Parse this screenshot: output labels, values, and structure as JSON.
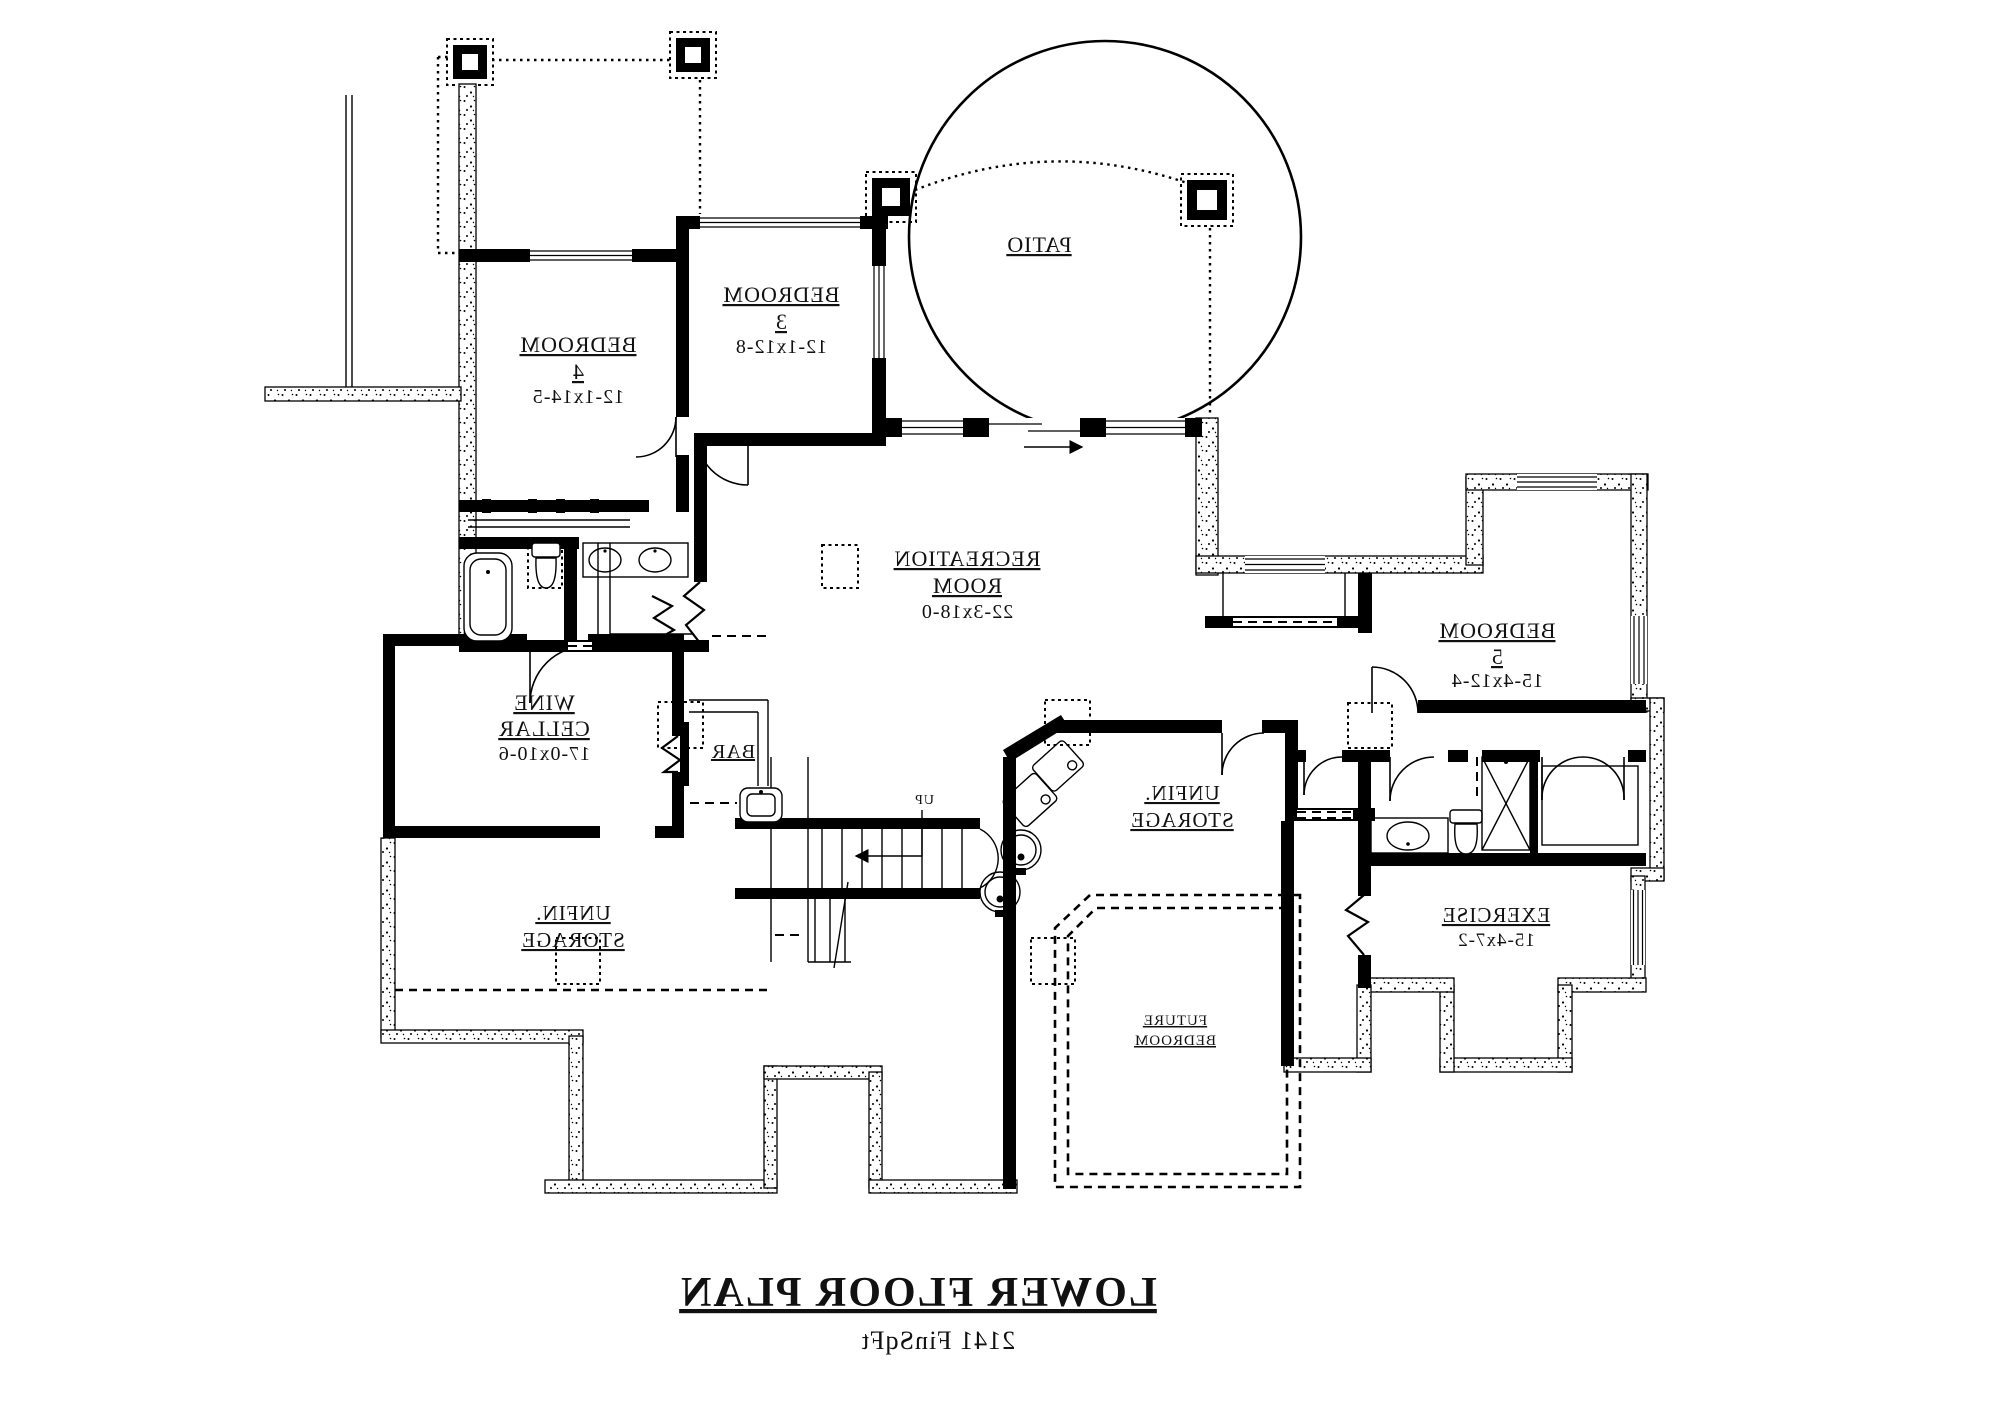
{
  "document": {
    "type": "floor-plan-drawing",
    "orientation": "mirrored",
    "background_color": "#ffffff",
    "line_color": "#000000"
  },
  "title_block": {
    "heading": "LOWER FLOOR PLAN",
    "area": "2141 FinSqFt"
  },
  "rooms": [
    {
      "name": "PATIO",
      "dims": ""
    },
    {
      "name": "BEDROOM 3",
      "dims": "12-1x12-8"
    },
    {
      "name": "BEDROOM 4",
      "dims": "12-1x14-5"
    },
    {
      "name": "RECREATION ROOM",
      "dims": "22-3x18-0"
    },
    {
      "name": "WINE CELLAR",
      "dims": "17-0x10-6"
    },
    {
      "name": "BAR",
      "dims": ""
    },
    {
      "name": "UNFIN. STORAGE (left)",
      "dims": ""
    },
    {
      "name": "UNFIN. STORAGE (center)",
      "dims": ""
    },
    {
      "name": "FUTURE BEDROOM",
      "dims": ""
    },
    {
      "name": "BEDROOM 5",
      "dims": "15-4x12-4"
    },
    {
      "name": "EXERCISE",
      "dims": "15-4x7-2"
    },
    {
      "name": "UP (stairs)",
      "dims": ""
    }
  ],
  "labels": [
    {
      "name": "patio-label",
      "x": 1039,
      "y": 252,
      "lines": [
        {
          "t": "PATIO",
          "dy": 0,
          "s": 22,
          "u": true
        }
      ]
    },
    {
      "name": "bedroom-3-label",
      "x": 781,
      "y": 302,
      "lines": [
        {
          "t": "BEDROOM",
          "dy": 0,
          "s": 22,
          "u": true
        },
        {
          "t": "3",
          "dy": 27,
          "s": 22,
          "u": true
        },
        {
          "t": "12-1x12-8",
          "dy": 51,
          "s": 20,
          "u": false
        }
      ]
    },
    {
      "name": "bedroom-4-label",
      "x": 578,
      "y": 352,
      "lines": [
        {
          "t": "BEDROOM",
          "dy": 0,
          "s": 22,
          "u": true
        },
        {
          "t": "4",
          "dy": 27,
          "s": 22,
          "u": true
        },
        {
          "t": "12-1x14-5",
          "dy": 51,
          "s": 20,
          "u": false
        }
      ]
    },
    {
      "name": "recreation-room-label",
      "x": 967,
      "y": 566,
      "lines": [
        {
          "t": "RECREATION",
          "dy": 0,
          "s": 22,
          "u": true
        },
        {
          "t": "ROOM",
          "dy": 27,
          "s": 22,
          "u": true
        },
        {
          "t": "22-3x18-0",
          "dy": 52,
          "s": 20,
          "u": false
        }
      ]
    },
    {
      "name": "wine-cellar-label",
      "x": 544,
      "y": 710,
      "lines": [
        {
          "t": "WINE",
          "dy": 0,
          "s": 22,
          "u": true
        },
        {
          "t": "CELLAR",
          "dy": 26,
          "s": 22,
          "u": true
        },
        {
          "t": "17-0x10-6",
          "dy": 50,
          "s": 20,
          "u": false
        }
      ]
    },
    {
      "name": "bar-label",
      "x": 733,
      "y": 758,
      "lines": [
        {
          "t": "BAR",
          "dy": 0,
          "s": 20,
          "u": true
        }
      ]
    },
    {
      "name": "unfin-storage-left-label",
      "x": 573,
      "y": 920,
      "lines": [
        {
          "t": "UNFIN.",
          "dy": 0,
          "s": 21,
          "u": true
        },
        {
          "t": "STORAGE",
          "dy": 27,
          "s": 21,
          "u": true
        }
      ]
    },
    {
      "name": "unfin-storage-center-label",
      "x": 1182,
      "y": 800,
      "lines": [
        {
          "t": "UNFIN.",
          "dy": 0,
          "s": 21,
          "u": true
        },
        {
          "t": "STORAGE",
          "dy": 27,
          "s": 21,
          "u": true
        }
      ]
    },
    {
      "name": "future-bedroom-label",
      "x": 1175,
      "y": 1025,
      "lines": [
        {
          "t": "FUTURE",
          "dy": 0,
          "s": 15,
          "u": true
        },
        {
          "t": "BEDROOM",
          "dy": 20,
          "s": 15,
          "u": true
        }
      ]
    },
    {
      "name": "bedroom-5-label",
      "x": 1497,
      "y": 638,
      "lines": [
        {
          "t": "BEDROOM",
          "dy": 0,
          "s": 22,
          "u": true
        },
        {
          "t": "5",
          "dy": 26,
          "s": 22,
          "u": true
        },
        {
          "t": "15-4x12-4",
          "dy": 49,
          "s": 20,
          "u": false
        }
      ]
    },
    {
      "name": "exercise-label",
      "x": 1496,
      "y": 922,
      "lines": [
        {
          "t": "EXERCISE",
          "dy": 0,
          "s": 21,
          "u": true
        },
        {
          "t": "15-4x7-2",
          "dy": 24,
          "s": 19,
          "u": false
        }
      ]
    },
    {
      "name": "up-label",
      "x": 924,
      "y": 804,
      "lines": [
        {
          "t": "UP",
          "dy": 0,
          "s": 14,
          "u": false
        }
      ]
    },
    {
      "name": "plan-title",
      "x": 918,
      "y": 1306,
      "lines": [
        {
          "t": "LOWER FLOOR PLAN",
          "dy": 0,
          "s": 42,
          "u": true,
          "b": true
        }
      ]
    },
    {
      "name": "plan-area",
      "x": 938,
      "y": 1349,
      "lines": [
        {
          "t": "2141 FinSqFt",
          "dy": 0,
          "s": 26,
          "u": false
        }
      ]
    }
  ]
}
